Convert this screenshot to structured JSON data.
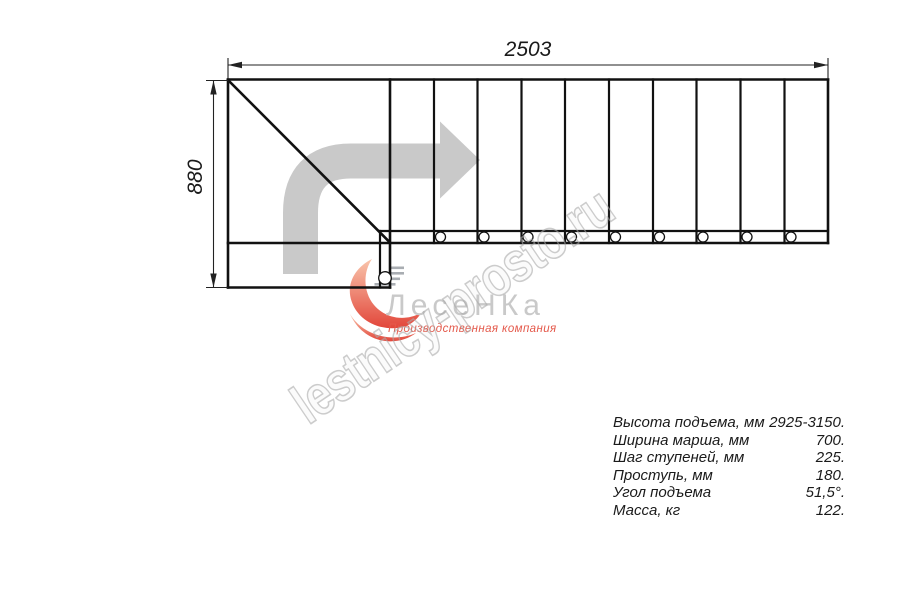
{
  "drawing": {
    "top_dimension": "2503",
    "left_dimension": "880"
  },
  "logo": {
    "name": "ЛесеНКа",
    "tagline": "Производственная компания",
    "accent_color": "#e4584a",
    "name_color": "#c9c9c9"
  },
  "watermark": {
    "text": "lestnicy-prosto.ru",
    "color": "#ababab"
  },
  "plan": {
    "arrow_color": "#c9c9c9",
    "line_color": "#111111"
  },
  "specs": {
    "rows": [
      {
        "label": "Высота подъема, мм",
        "value": "2925-3150."
      },
      {
        "label": "Ширина марша, мм",
        "value": "700."
      },
      {
        "label": "Шаг ступеней, мм",
        "value": "225."
      },
      {
        "label": "Проступь, мм",
        "value": "180."
      },
      {
        "label": "Угол подъема",
        "value": "51,5°."
      },
      {
        "label": "Масса, кг",
        "value": "122."
      }
    ]
  }
}
